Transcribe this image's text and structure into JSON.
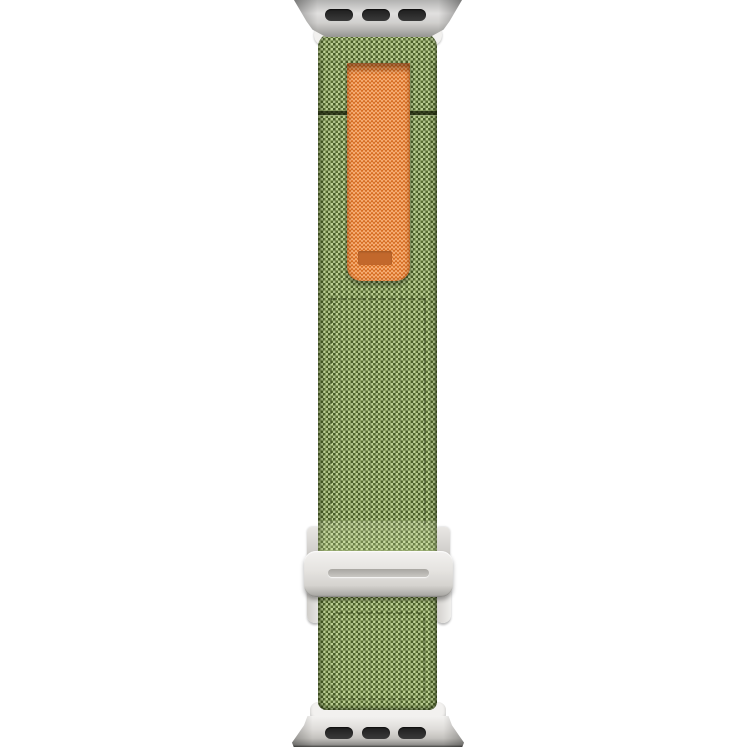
{
  "meta": {
    "description": "Product photo of a green woven trail-loop style watch band on a white background",
    "background_color": "#ffffff"
  },
  "colors": {
    "bg_white": "#ffffff",
    "band_green": "#7d9a4a",
    "band_green_light": "#b3cc80",
    "band_green_dark": "#3f4f25",
    "tab_orange": "#ef8132",
    "tab_label_orange": "#c2682c",
    "metal_silver_light": "#f2f1ef",
    "metal_silver": "#d5d3cf",
    "metal_silver_dark": "#a3a29e",
    "slot_dark": "#3a3a3a"
  },
  "parts": {
    "top_adapter": {
      "name": "watch lug adapter (top)",
      "slot_count": 3
    },
    "bottom_adapter": {
      "name": "watch lug adapter (bottom)",
      "slot_count": 3
    },
    "band": {
      "name": "woven nylon band",
      "material": "green woven fabric"
    },
    "pull_tab": {
      "name": "orange pull loop",
      "label_text": ""
    },
    "buckle": {
      "name": "G-hook buckle",
      "finish": "silver"
    }
  }
}
